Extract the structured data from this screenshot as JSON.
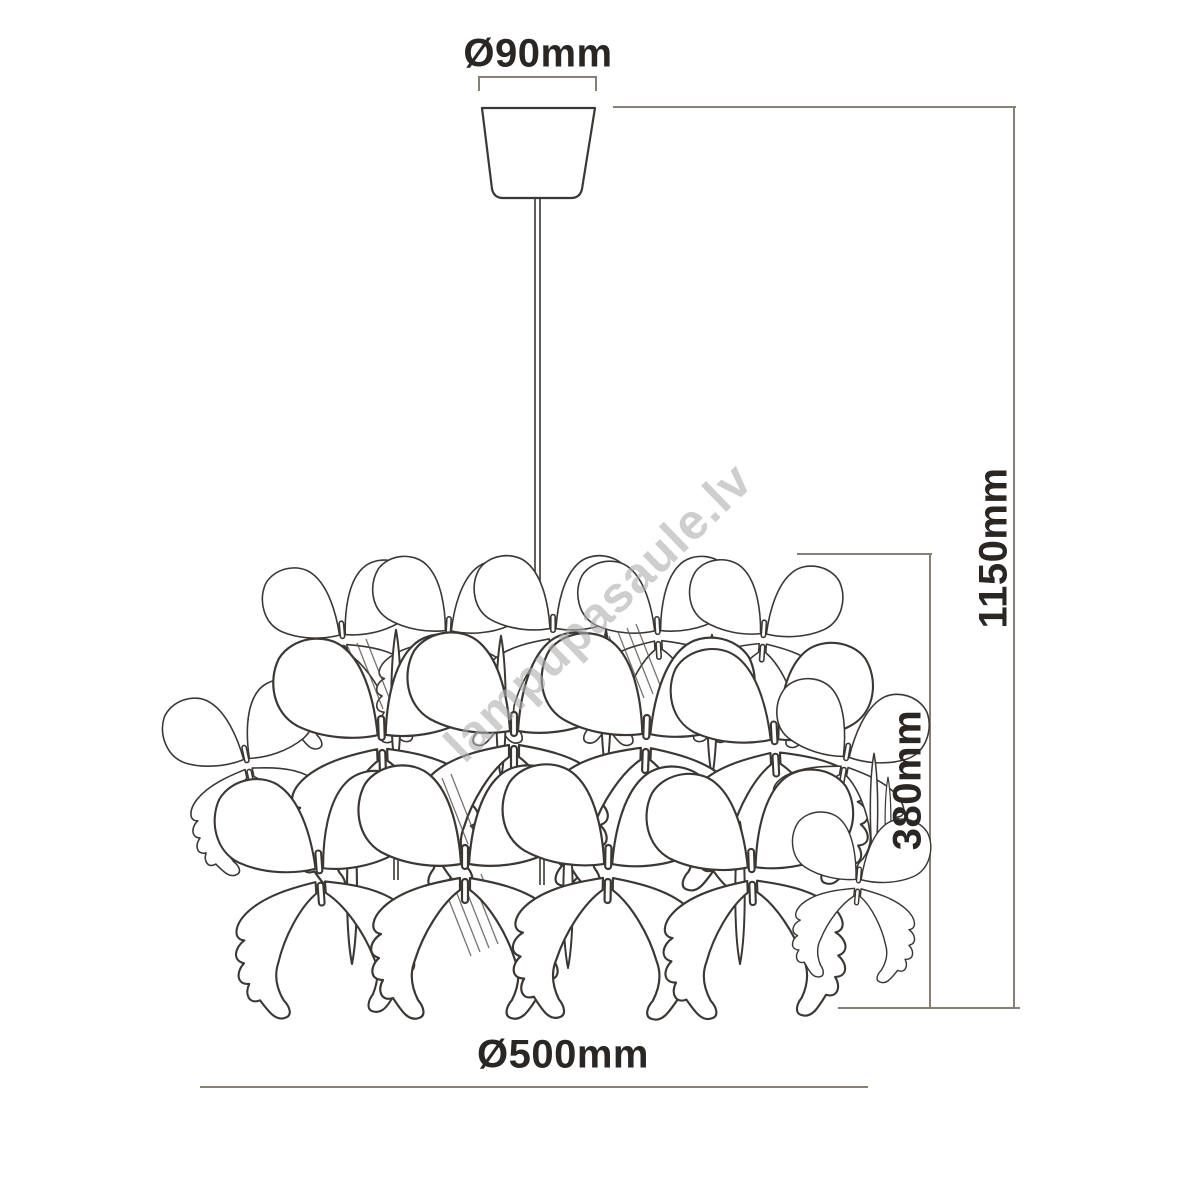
{
  "drawing": {
    "title": "butterfly pendant lamp dimension drawing",
    "labels": {
      "canopy_diameter": "Ø90mm",
      "overall_height": "1150mm",
      "shade_height": "380mm",
      "shade_diameter": "Ø500mm"
    },
    "watermark": "lampupasaule.lv",
    "colors": {
      "dimension_line": "#867f76",
      "drawing_outline": "#3b3734",
      "label_text": "#2a2624",
      "watermark_text": "#adadad",
      "background": "#ffffff"
    }
  }
}
